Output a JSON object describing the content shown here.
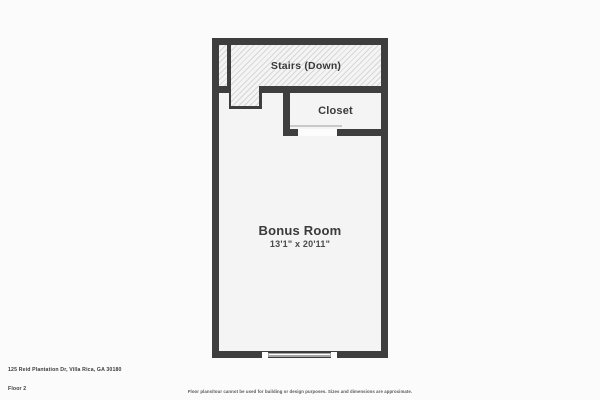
{
  "plan": {
    "stairs_label": "Stairs (Down)",
    "closet_label": "Closet",
    "bonus_room": {
      "name": "Bonus Room",
      "dimensions": "13'1\" x 20'11\""
    }
  },
  "footer": {
    "address": "125 Reid Plantation Dr, Villa Rica, GA 30180",
    "floor": "Floor 2",
    "disclaimer": "Floor plans/tour cannot be used for building or design purposes. Sizes and dimensions are approximate."
  },
  "colors": {
    "wall": "#3e3e3e",
    "room_fill": "#f4f4f4",
    "hatch_line": "#d7d7d7",
    "page_background": "#fbfbfb",
    "label_text": "#3a3a3a"
  }
}
